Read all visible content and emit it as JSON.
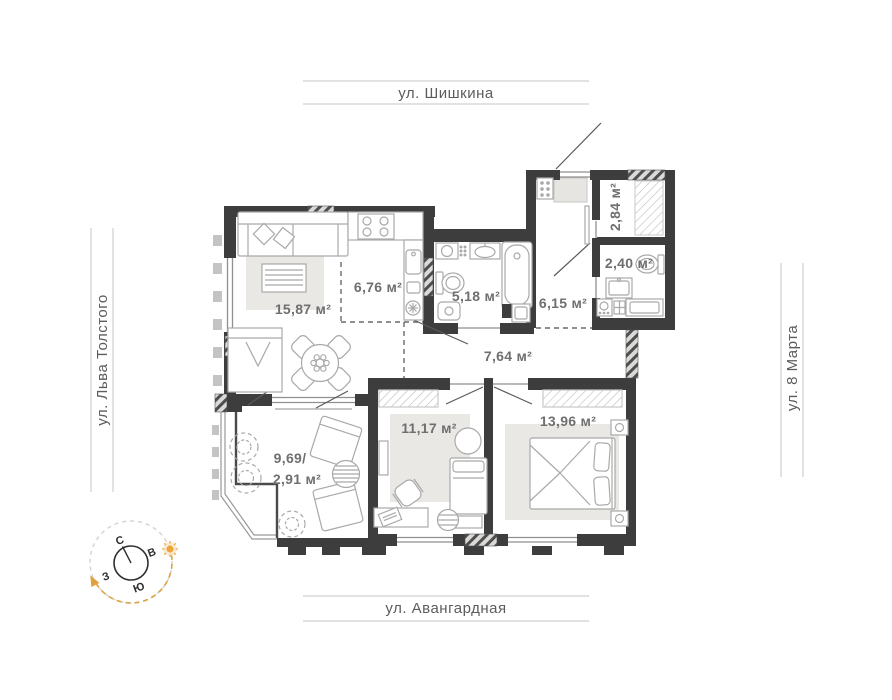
{
  "streets": {
    "top": "ул. Шишкина",
    "bottom": "ул. Авангардная",
    "left": "ул. Льва Толстого",
    "right": "ул. 8 Марта"
  },
  "rooms": {
    "living": {
      "label": "15,87 м²"
    },
    "kitchen": {
      "label": "6,76 м²"
    },
    "bathroom": {
      "label": "5,18 м²"
    },
    "hallway": {
      "label": "6,15 м²"
    },
    "storage": {
      "label": "2,84 м²"
    },
    "wc": {
      "label": "2,40 м²"
    },
    "corridor": {
      "label": "7,64 м²"
    },
    "bedroom_small": {
      "label": "11,17 м²"
    },
    "bedroom_master": {
      "label": "13,96 м²"
    },
    "balcony": {
      "label_total": "9,69/",
      "label_reduced": "2,91 м²"
    }
  },
  "compass": {
    "north": "С",
    "east": "В",
    "south": "Ю",
    "west": "З"
  },
  "colors": {
    "wall": "#3d3d3d",
    "room_label": "#6f6f6f",
    "street_label": "#5c5c5c",
    "accent_orange": "#e5a03c",
    "furniture_line": "#a9a9a9",
    "rug_fill": "#eae8e5"
  }
}
